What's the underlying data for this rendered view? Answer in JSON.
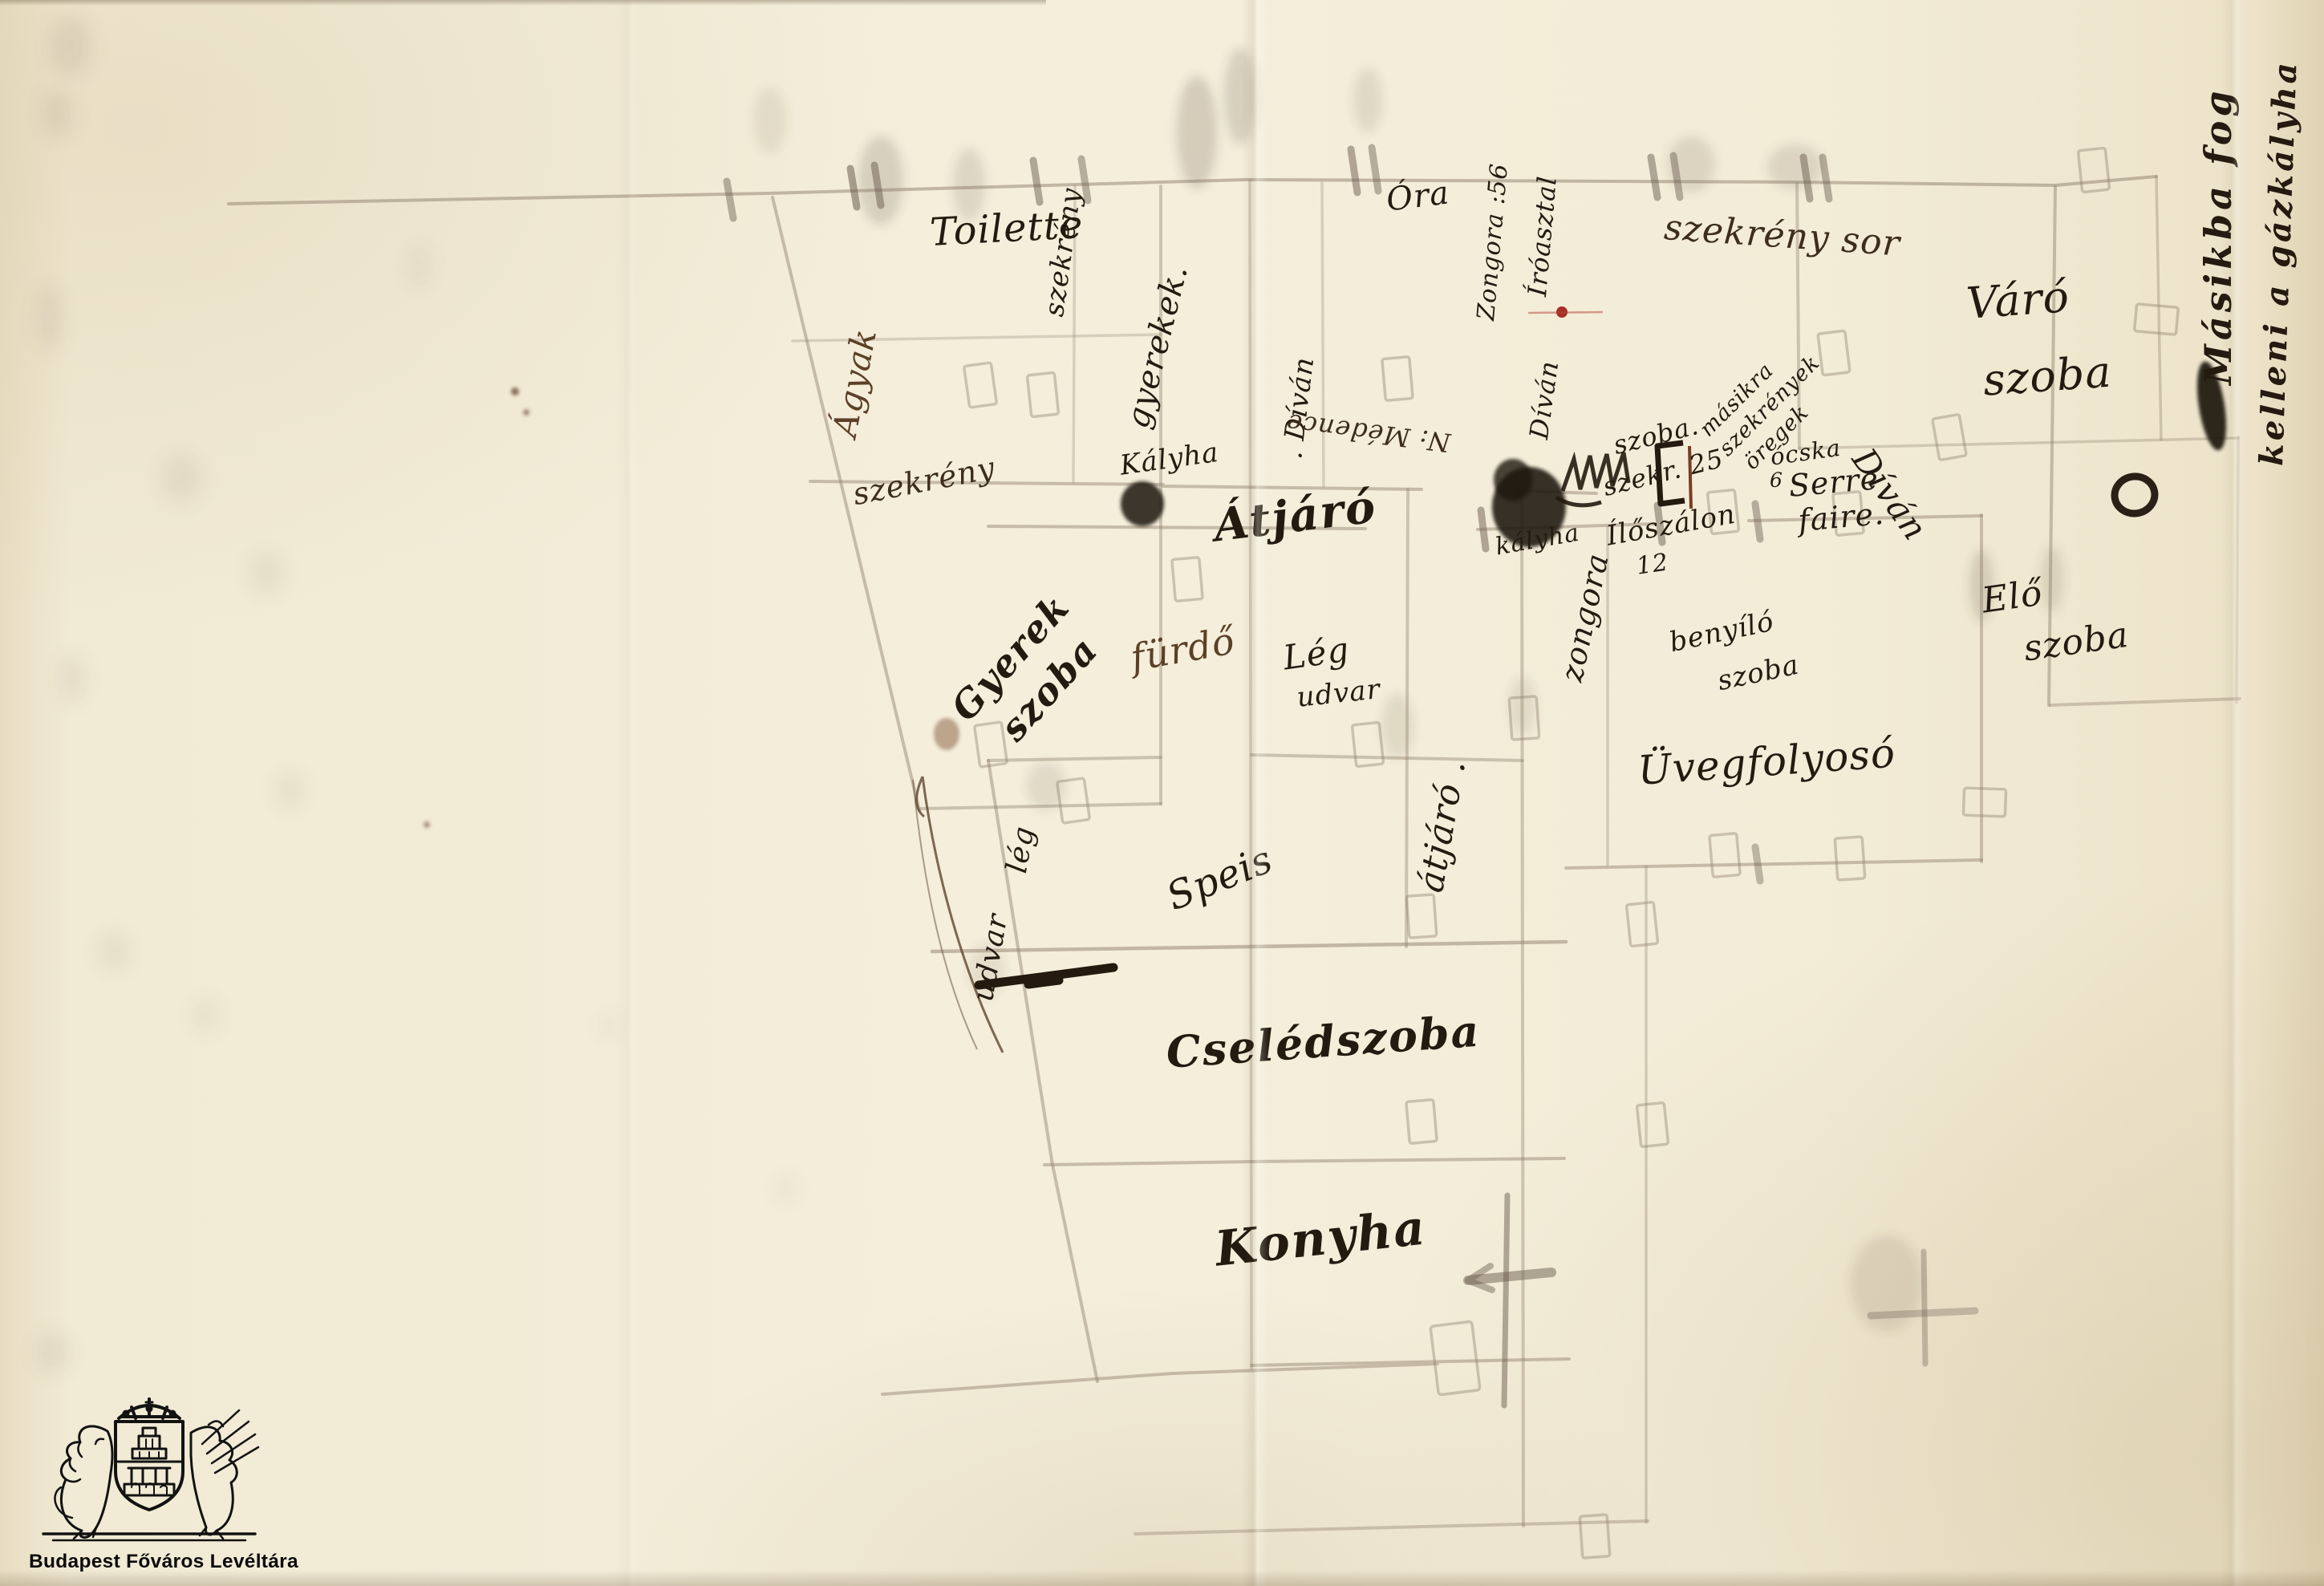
{
  "colors": {
    "paper": "#f2ebd6",
    "ink": "#241a10",
    "brown_ink": "#5b4027",
    "pencil": "#8d7f6b",
    "red_mark": "#a63026"
  },
  "rooms": {
    "toilette": "Toilette",
    "varo_1": "Váró",
    "varo_2": "szoba",
    "gyerek_1": "Gyerek",
    "gyerek_2": "szoba",
    "atjaro": "Átjáró",
    "atjaro_vert": "átjáró .",
    "furdo": "fürdő",
    "leg_1": "Lég",
    "udvar_1": "udvar",
    "leg_2": "lég",
    "udvar_2": "udvar",
    "speis": "Speis",
    "cseledszoba": "Cselédszoba",
    "konyha": "Konyha",
    "uvegfolyoso": "Üvegfolyosó",
    "elo_1": "Elő",
    "elo_2": "szoba",
    "benyilo_1": "benyíló",
    "benyilo_2": "szoba"
  },
  "furniture": {
    "ora": "Óra",
    "szekreny_vert": "szekrény",
    "gyerekek": "gyerekek.",
    "agyak": "Ágyak",
    "szekreny_diag": "szekrény",
    "zongora_1": "Zongora :56",
    "iroasztal": "Íróasztal",
    "szekrenysor": "szekrény sor",
    "kalyha_1": "Kályha",
    "kalyha_2": "kályha",
    "divan_1": ". Díván",
    "divan_2": "Díván",
    "divan_3": "Díván",
    "zongora_2": "zongora",
    "medence": "N: Médence",
    "ocska": "ócska",
    "ocska_num": "6",
    "serre_1": "Serre",
    "serre_2": "faire.",
    "masikra_1": "másikra",
    "masikra_2": "szekrények",
    "masikra_3": "öregek",
    "szoba_note": "szoba.",
    "szekr_note": "szekr. 25",
    "iloszalon": "Ílőszálon",
    "iloszalon_num": "12"
  },
  "margin_note": {
    "line1": "Másikba fog",
    "line2": "kelleni a gázkályha"
  },
  "logo": {
    "caption": "Budapest Főváros Levéltára"
  }
}
